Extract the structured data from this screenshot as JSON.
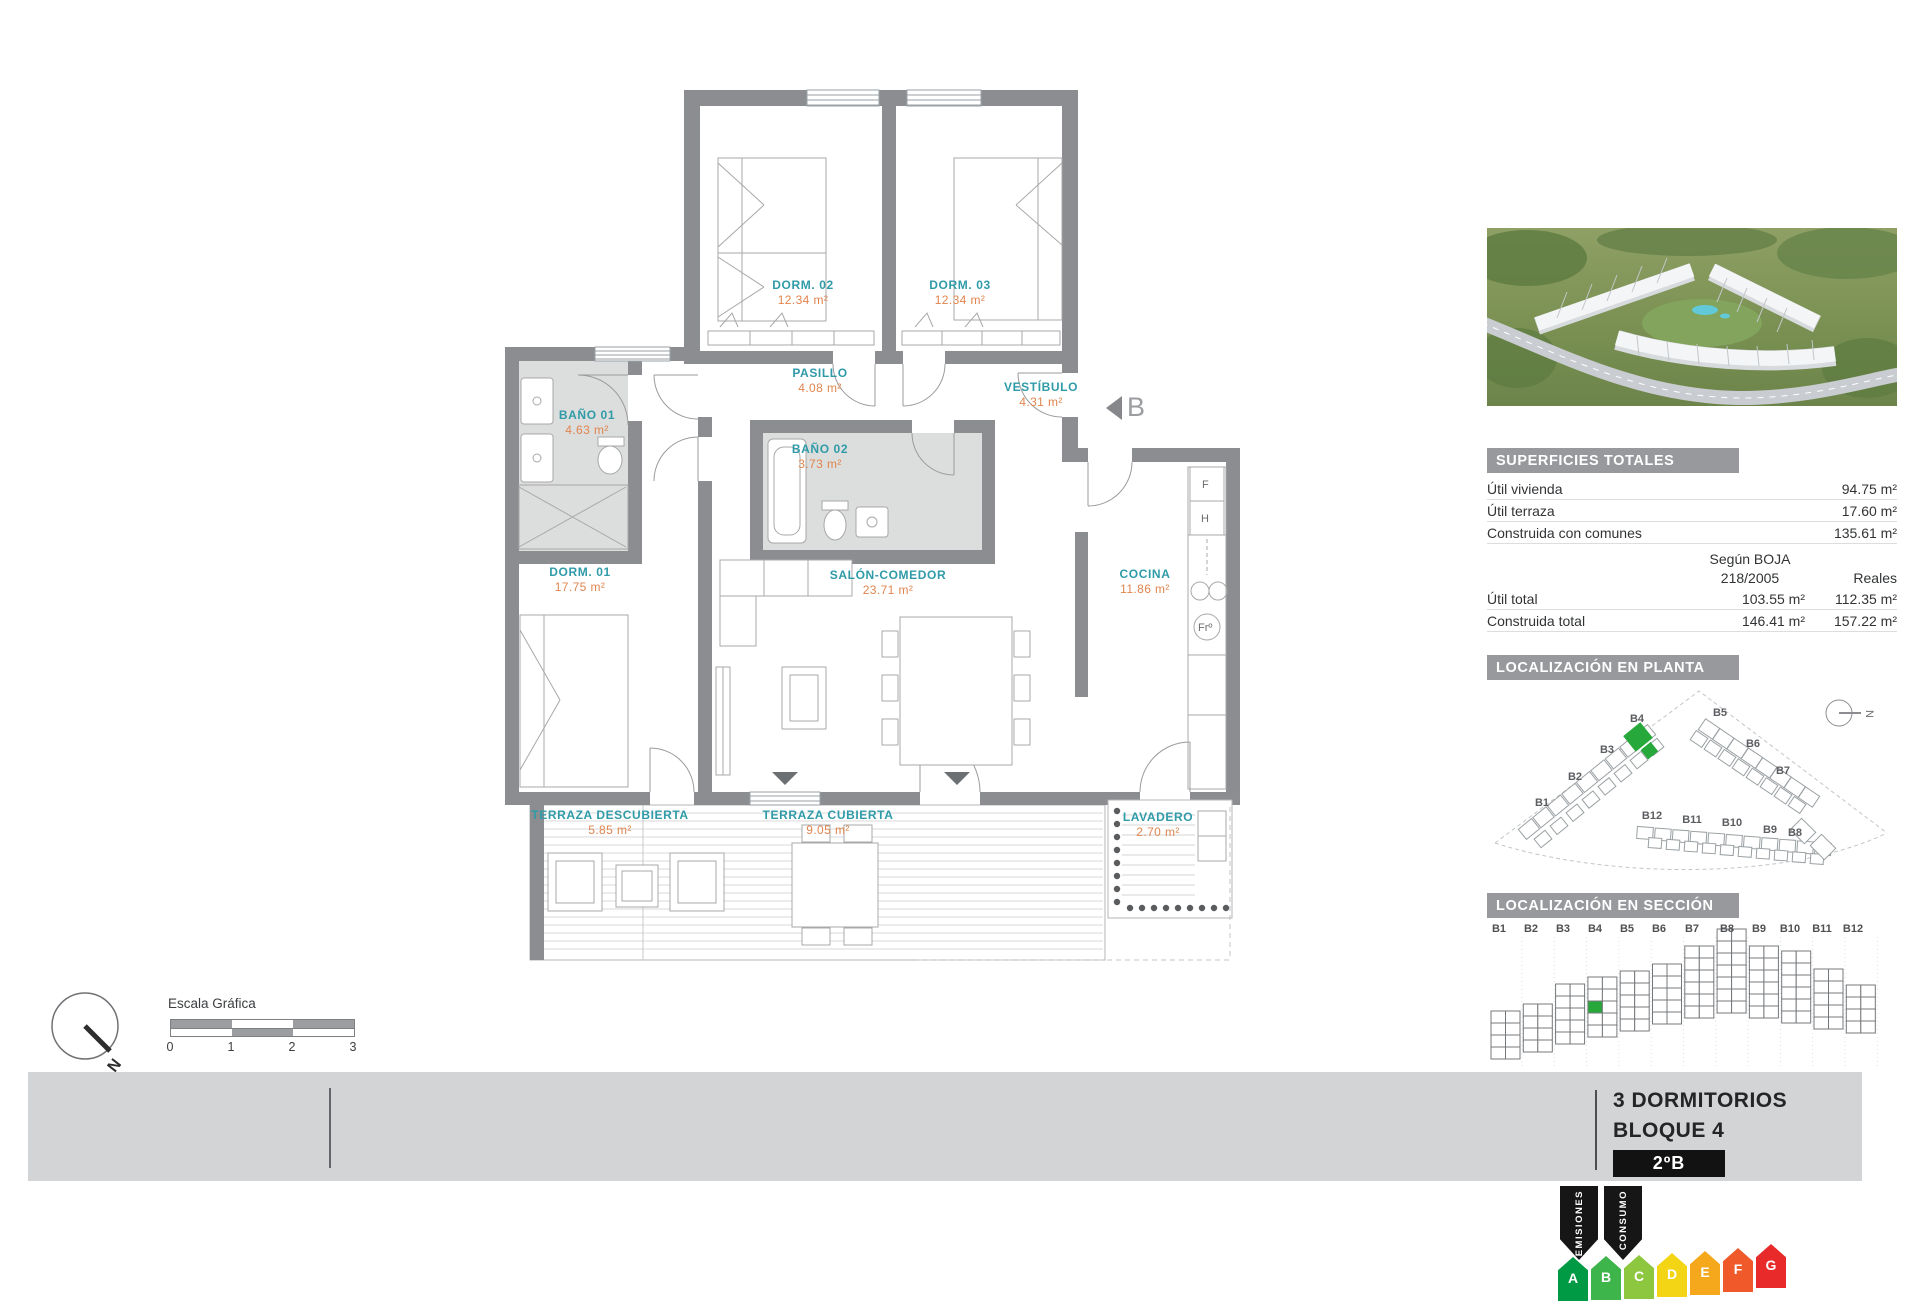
{
  "floor_plan": {
    "rooms": [
      {
        "name": "DORM. 02",
        "area": "12.34 m²",
        "x": 383,
        "y": 238
      },
      {
        "name": "DORM. 03",
        "area": "12.34 m²",
        "x": 540,
        "y": 238
      },
      {
        "name": "PASILLO",
        "area": "4.08 m²",
        "x": 400,
        "y": 326
      },
      {
        "name": "VESTÍBULO",
        "area": "4.31 m²",
        "x": 621,
        "y": 340
      },
      {
        "name": "BAÑO 01",
        "area": "4.63 m²",
        "x": 167,
        "y": 368
      },
      {
        "name": "BAÑO 02",
        "area": "3.73 m²",
        "x": 400,
        "y": 402
      },
      {
        "name": "DORM. 01",
        "area": "17.75 m²",
        "x": 160,
        "y": 525
      },
      {
        "name": "SALÓN-COMEDOR",
        "area": "23.71 m²",
        "x": 468,
        "y": 528
      },
      {
        "name": "COCINA",
        "area": "11.86 m²",
        "x": 725,
        "y": 527
      },
      {
        "name": "TERRAZA DESCUBIERTA",
        "area": "5.85 m²",
        "x": 190,
        "y": 768
      },
      {
        "name": "TERRAZA CUBIERTA",
        "area": "9.05 m²",
        "x": 408,
        "y": 768
      },
      {
        "name": "LAVADERO",
        "area": "2.70 m²",
        "x": 738,
        "y": 770
      }
    ],
    "section_marker": "B",
    "appliances": [
      "F",
      "H",
      "Frº"
    ]
  },
  "scale_bar": {
    "title": "Escala Gráfica",
    "ticks": [
      {
        "label": "0",
        "x": 170
      },
      {
        "label": "1",
        "x": 231
      },
      {
        "label": "2",
        "x": 292
      },
      {
        "label": "3",
        "x": 353
      }
    ]
  },
  "north": {
    "label": "N"
  },
  "sidebar": {
    "superficies": {
      "title": "SUPERFICIES TOTALES",
      "simple_rows": [
        {
          "label": "Útil vivienda",
          "value": "94.75 m²"
        },
        {
          "label": "Útil terraza",
          "value": "17.60 m²"
        },
        {
          "label": "Construida con comunes",
          "value": "135.61 m²"
        }
      ],
      "col_header_line1": "Según BOJA",
      "col_header_line2": "218/2005",
      "col_header_right": "Reales",
      "double_rows": [
        {
          "label": "Útil total",
          "boja": "103.55 m²",
          "reales": "112.35 m²"
        },
        {
          "label": "Construida total",
          "boja": "146.41 m²",
          "reales": "157.22 m²"
        }
      ]
    },
    "planta": {
      "title": "LOCALIZACIÓN EN PLANTA",
      "north": "N",
      "highlight": "B4",
      "blocks": [
        {
          "label": "B1",
          "x": 55,
          "y": 120
        },
        {
          "label": "B2",
          "x": 88,
          "y": 94
        },
        {
          "label": "B3",
          "x": 120,
          "y": 67
        },
        {
          "label": "B4",
          "x": 150,
          "y": 36
        },
        {
          "label": "B5",
          "x": 233,
          "y": 30
        },
        {
          "label": "B6",
          "x": 266,
          "y": 61
        },
        {
          "label": "B7",
          "x": 296,
          "y": 88
        },
        {
          "label": "B8",
          "x": 308,
          "y": 150
        },
        {
          "label": "B9",
          "x": 283,
          "y": 147
        },
        {
          "label": "B10",
          "x": 245,
          "y": 140
        },
        {
          "label": "B11",
          "x": 205,
          "y": 137
        },
        {
          "label": "B12",
          "x": 165,
          "y": 133
        }
      ]
    },
    "seccion": {
      "title": "LOCALIZACIÓN EN SECCIÓN",
      "highlight": "B4",
      "columns": [
        {
          "label": "B1",
          "x": 12
        },
        {
          "label": "B2",
          "x": 44
        },
        {
          "label": "B3",
          "x": 76
        },
        {
          "label": "B4",
          "x": 108
        },
        {
          "label": "B5",
          "x": 140
        },
        {
          "label": "B6",
          "x": 172
        },
        {
          "label": "B7",
          "x": 205
        },
        {
          "label": "B8",
          "x": 240
        },
        {
          "label": "B9",
          "x": 272
        },
        {
          "label": "B10",
          "x": 303
        },
        {
          "label": "B11",
          "x": 335
        },
        {
          "label": "B12",
          "x": 366
        }
      ]
    }
  },
  "title_block": {
    "line1": "3 DORMITORIOS",
    "line2": "BLOQUE 4",
    "unit": "2ºB"
  },
  "energy": {
    "tags": [
      {
        "label": "EMISIONES",
        "x": 1560
      },
      {
        "label": "CONSUMO",
        "x": 1604
      }
    ],
    "scale": [
      {
        "letter": "A",
        "color": "#009a44",
        "x": 1558,
        "top": 1257
      },
      {
        "letter": "B",
        "color": "#3db54a",
        "x": 1591,
        "top": 1256
      },
      {
        "letter": "C",
        "color": "#8dc63f",
        "x": 1624,
        "top": 1255
      },
      {
        "letter": "D",
        "color": "#f4d515",
        "x": 1657,
        "top": 1253
      },
      {
        "letter": "E",
        "color": "#f5a81c",
        "x": 1690,
        "top": 1251
      },
      {
        "letter": "F",
        "color": "#f0592a",
        "x": 1723,
        "top": 1248
      },
      {
        "letter": "G",
        "color": "#e92a2a",
        "x": 1756,
        "top": 1244
      }
    ]
  },
  "colors": {
    "wall": "#8b8d90",
    "room_name": "#2f9ba8",
    "room_area": "#e0854e",
    "header_bar": "#97999c",
    "highlight_green": "#27a83a",
    "band": "#d2d4d6"
  }
}
